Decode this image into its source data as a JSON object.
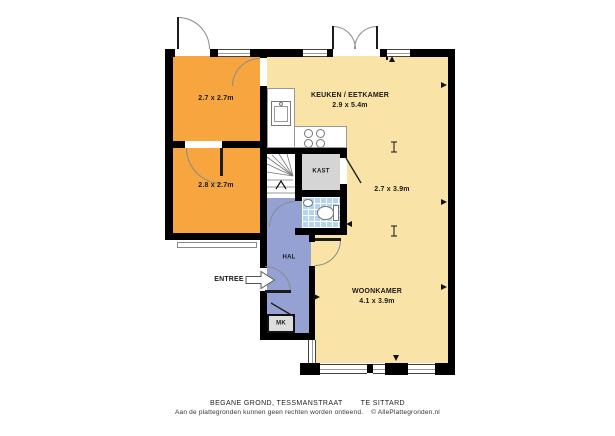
{
  "colors": {
    "wall": "#000000",
    "room_orange": "#f6a53f",
    "room_cream": "#fae3a7",
    "hall_blue": "#95a1d3",
    "tile_blue": "#b5d4ee",
    "closet_gray": "#d5d5d5",
    "arc_gray": "#8a8a8a"
  },
  "rooms": {
    "bedroom_top": {
      "dims": "2.7 x 2.7m"
    },
    "bedroom_bottom": {
      "dims": "2.8 x 2.7m"
    },
    "kitchen": {
      "name": "KEUKEN / EETKAMER",
      "dims": "2.9 x 5.4m"
    },
    "closet": {
      "name": "KAST"
    },
    "middle_zone": {
      "dims": "2.7 x 3.9m"
    },
    "hall": {
      "name": "HAL"
    },
    "living": {
      "name": "WOONKAMER",
      "dims": "4.1 x 3.9m"
    },
    "meter_closet": {
      "name": "MK"
    },
    "entrance": {
      "name": "ENTREE"
    }
  },
  "footer": {
    "line1_left": "BEGANE GROND, TESSMANSTRAAT",
    "line1_right": "TE SITTARD",
    "line2_text": "Aan de plattegronden kunnen geen rechten worden ontleend.",
    "line2_copyright": "© AllePlattegronden.nl"
  }
}
